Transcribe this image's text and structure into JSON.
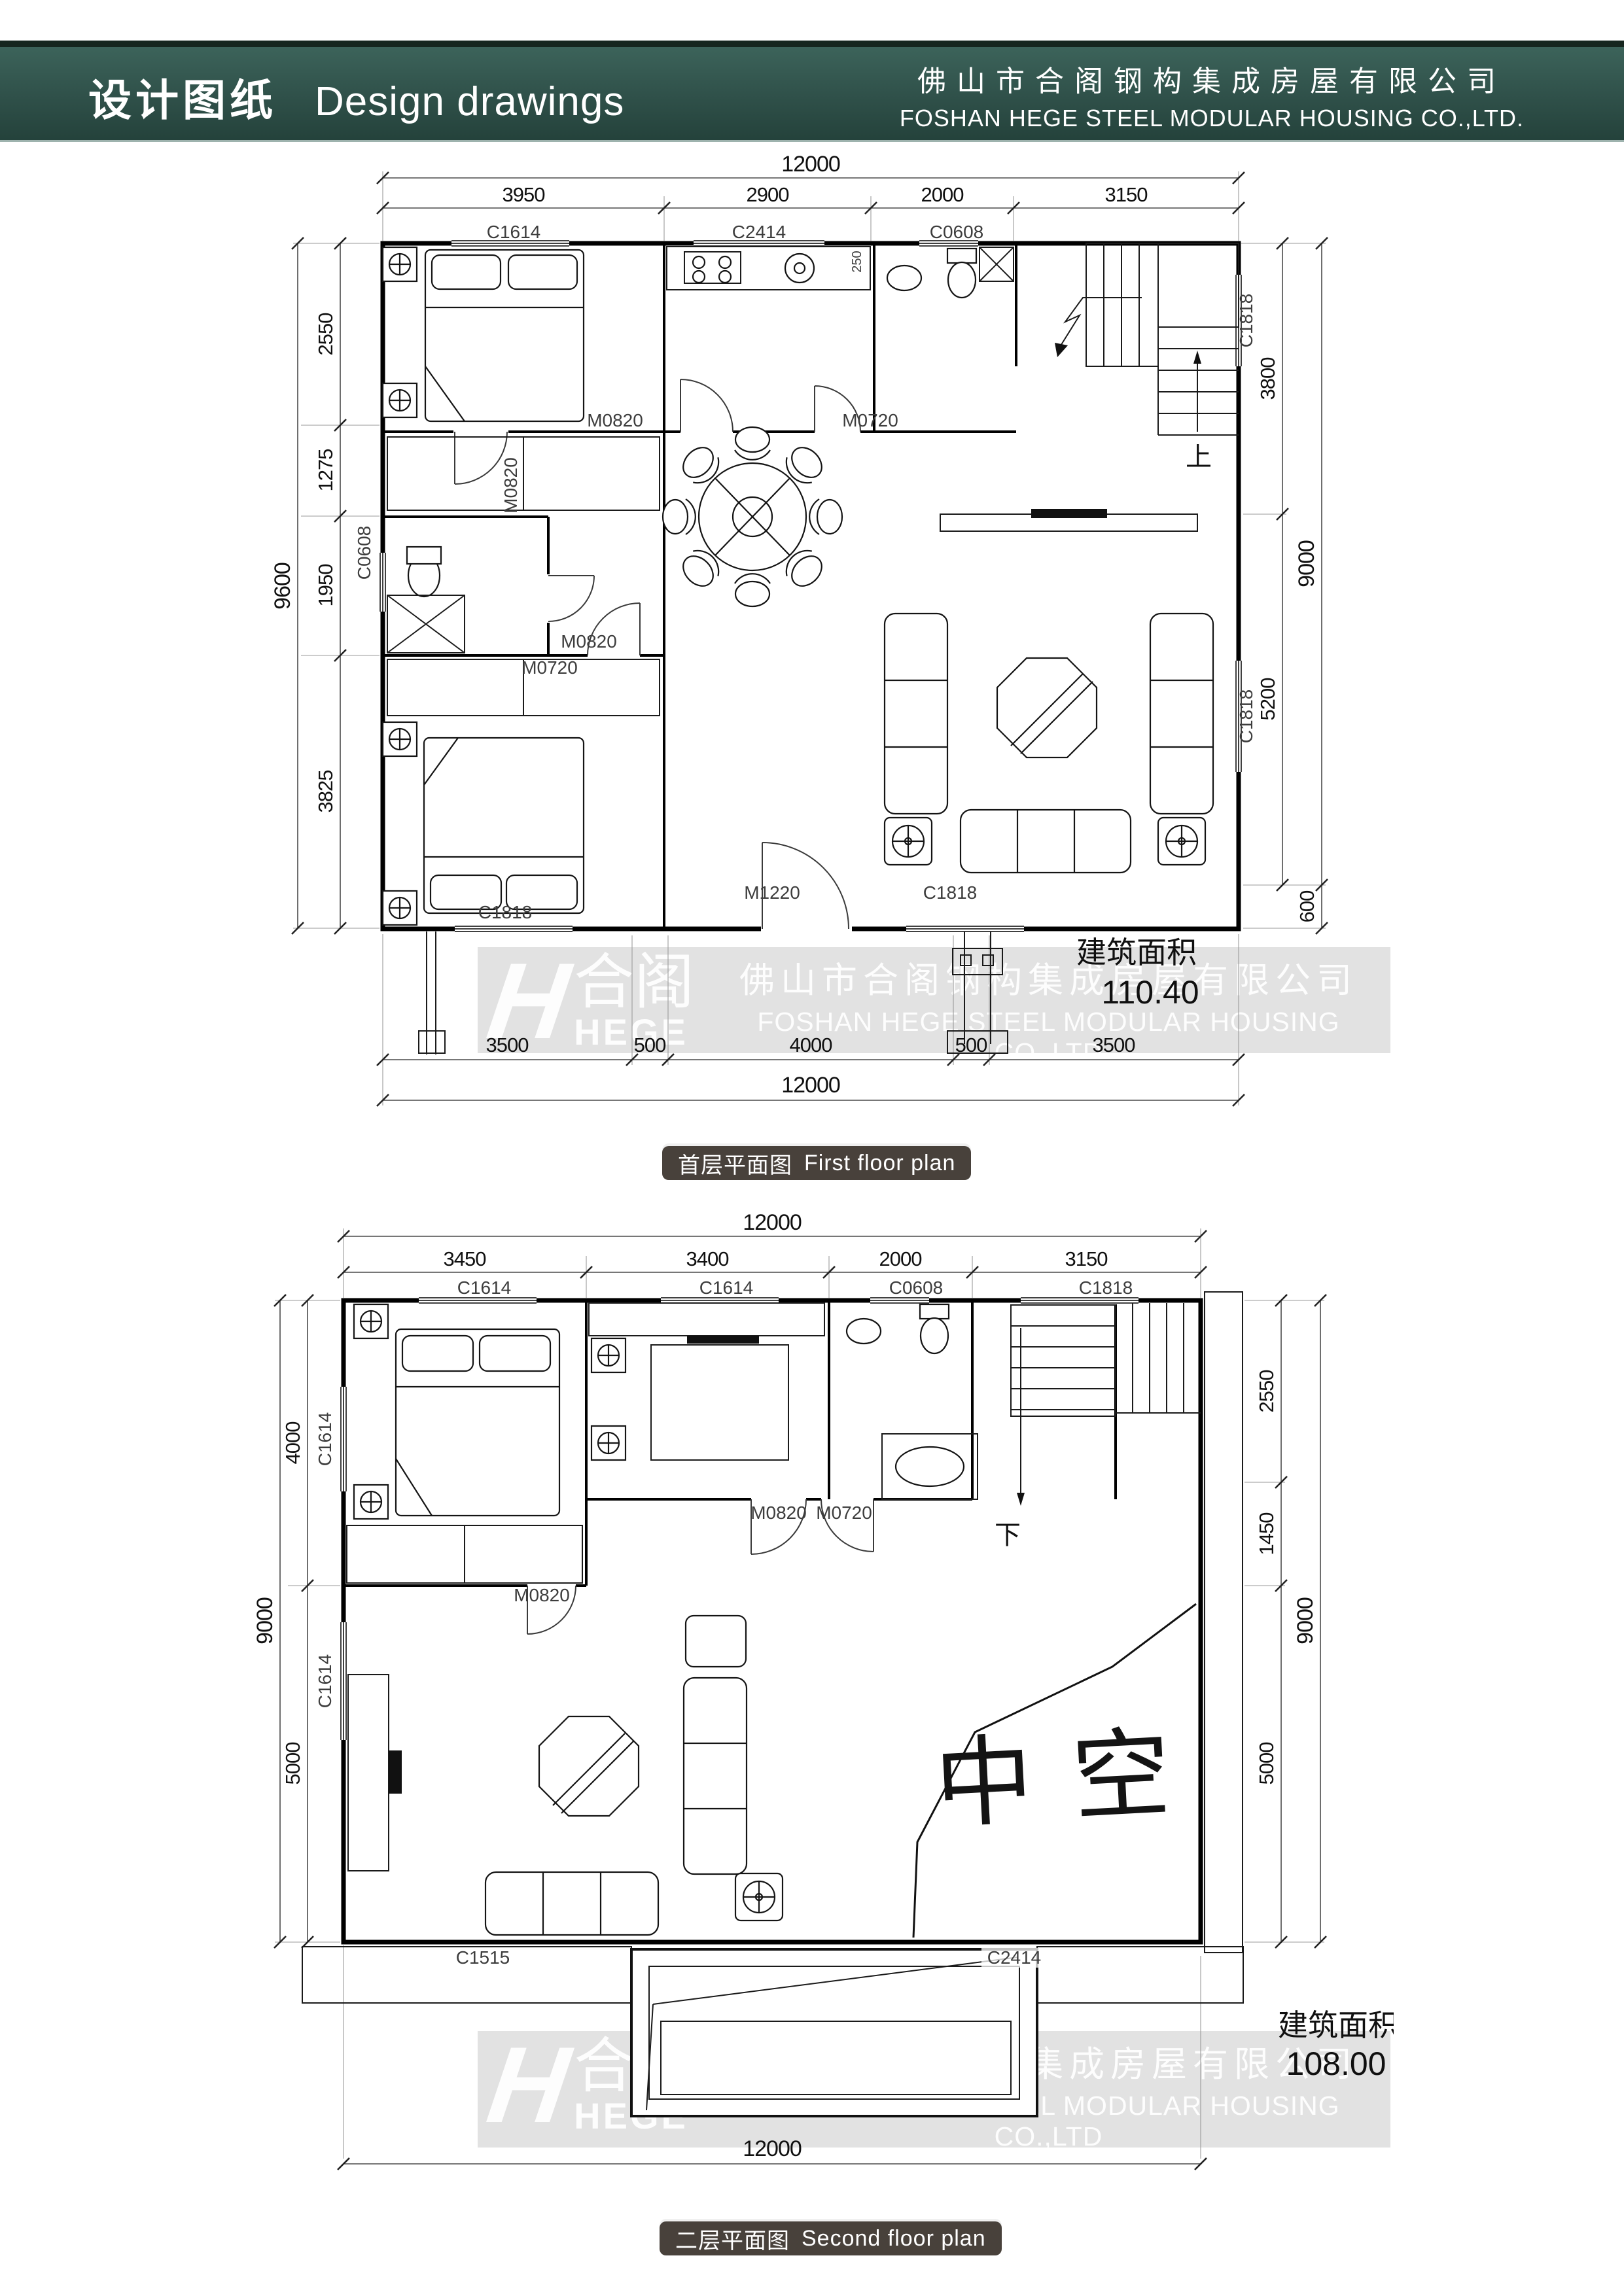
{
  "header": {
    "title_cn": "设计图纸",
    "title_en": "Design drawings",
    "company_cn": "佛山市合阁钢构集成房屋有限公司",
    "company_en": "FOSHAN HEGE STEEL MODULAR HOUSING CO.,LTD."
  },
  "colors": {
    "header_teal": "#2f5049",
    "badge_bg": "#48413b",
    "band_gray": "#e2e2e2",
    "line": "#000000"
  },
  "watermark": {
    "logo_cn": "合阁",
    "logo_en": "HEGE",
    "line1": "佛山市合阁钢构集成房屋有限公司",
    "line2": "FOSHAN HEGE STEEL MODULAR HOUSING CO.,LTD",
    "line3": "wwww.fchege.com  fchege@fchege.com  Tel:13826078788"
  },
  "floor1": {
    "badge_cn": "首层平面图",
    "badge_en": "First floor plan",
    "area_label": "建筑面积",
    "area_value": "110.40",
    "stair": "上",
    "dims": {
      "top_total": "12000",
      "top": [
        "3950",
        "2900",
        "2000",
        "3150"
      ],
      "left_total": "9600",
      "left": [
        "2550",
        "1275",
        "1950",
        "3825"
      ],
      "right": [
        "3800",
        "5200"
      ],
      "right_outer": [
        "9000",
        "600"
      ],
      "bottom": [
        "3500",
        "500",
        "4000",
        "500",
        "3500"
      ],
      "bottom_total": "12000",
      "micro": "250"
    },
    "openings": {
      "win_top": [
        "C1614",
        "C2414",
        "C0608"
      ],
      "win_left": "C0608",
      "win_right": [
        "C1818",
        "C1818"
      ],
      "win_bottom": [
        "C1818",
        "C1818"
      ],
      "door_bed1": "M0820",
      "door_kitchen": "M0820",
      "door_bath": "M0720",
      "door_bed2": "M0820",
      "door_bath2": "M0720",
      "door_entry": "M1220"
    }
  },
  "floor2": {
    "badge_cn": "二层平面图",
    "badge_en": "Second floor plan",
    "area_label": "建筑面积",
    "area_value": "108.00",
    "stair": "下",
    "void_label": "中空",
    "dims": {
      "top_total": "12000",
      "top": [
        "3450",
        "3400",
        "2000",
        "3150"
      ],
      "left_total": "9000",
      "left": [
        "4000",
        "5000"
      ],
      "right_total": "9000",
      "right": [
        "2550",
        "1450",
        "5000"
      ],
      "bottom_total": "12000"
    },
    "openings": {
      "win_top": [
        "C1614",
        "C1614",
        "C0608",
        "C1818"
      ],
      "win_left": [
        "C1614",
        "C1614"
      ],
      "door_closet": "M0820",
      "door_mid": "M0820",
      "door_bath": "M0720",
      "roof_left": "C1515",
      "roof_right": "C2414"
    }
  }
}
